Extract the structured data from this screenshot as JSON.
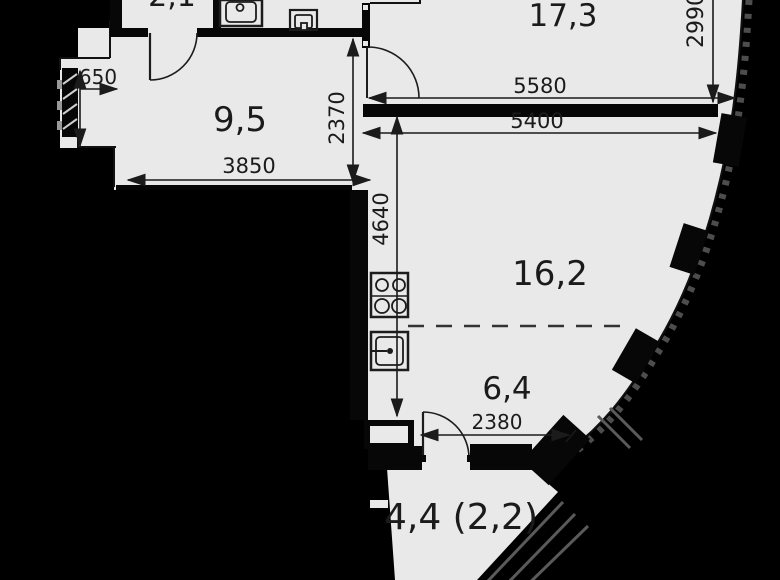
{
  "plan": {
    "title": "apartment-floor-plan",
    "rooms": [
      {
        "name": "hallway-top",
        "area_label": "2,1"
      },
      {
        "name": "hall-room",
        "area_label": "9,5"
      },
      {
        "name": "living-room",
        "area_label": "17,3"
      },
      {
        "name": "kitchen-living",
        "area_label": "16,2"
      },
      {
        "name": "kitchen-zone",
        "area_label": "6,4"
      },
      {
        "name": "balcony",
        "area_label": "4,4 (2,2)"
      }
    ],
    "dimensions_mm": {
      "niche_offset": "650",
      "hall_depth": "2370",
      "hall_width": "3850",
      "kitchen_wall_length": "4640",
      "living_room_height": "2990",
      "living_room_width_inner": "5580",
      "living_room_width": "5400",
      "balcony_opening": "2380"
    },
    "fixtures": [
      {
        "name": "bathroom-sink"
      },
      {
        "name": "washbasin"
      },
      {
        "name": "stove-4-burners"
      },
      {
        "name": "kitchen-sink"
      }
    ],
    "colors": {
      "background": "#000000",
      "floor": "#e9e9e9",
      "wall": "#070707",
      "line": "#1b1b1b"
    }
  }
}
